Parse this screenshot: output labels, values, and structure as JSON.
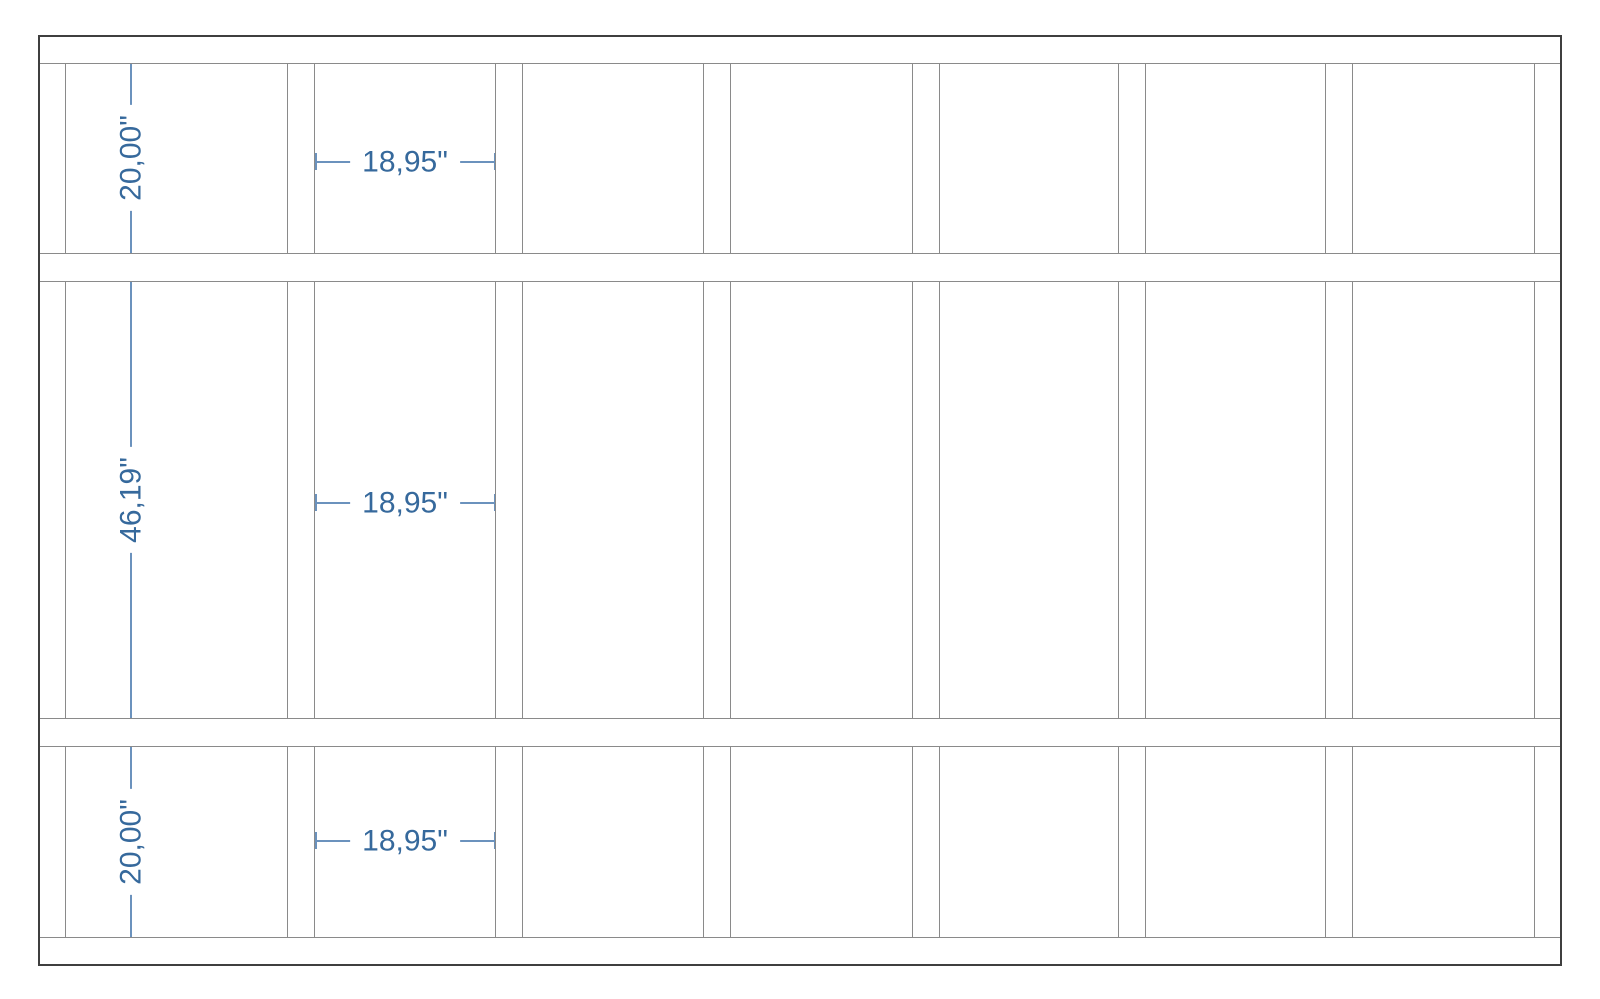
{
  "title": "Wall framing elevation drawing",
  "colors": {
    "background": "#ffffff",
    "frame_line": "#3f3f3f",
    "member_line": "#8a8a8a",
    "dim_line": "#6b92bd",
    "dim_ext_line": "#a9c1da",
    "dim_text": "#36699c"
  },
  "drawing": {
    "canvas": {
      "width": 1600,
      "height": 999
    },
    "frame": {
      "x": 38,
      "y": 35,
      "width": 1524,
      "height": 931
    },
    "horizontal_member_lines_y": [
      63,
      253,
      281,
      718,
      746,
      937
    ],
    "stud_bands": [
      {
        "name": "top-band",
        "y1": 63,
        "y2": 253
      },
      {
        "name": "middle-band",
        "y1": 281,
        "y2": 718
      },
      {
        "name": "bottom-band",
        "y1": 746,
        "y2": 937
      }
    ],
    "studs_x": [
      [
        38,
        66
      ],
      [
        287,
        315
      ],
      [
        495,
        523
      ],
      [
        703,
        731
      ],
      [
        912,
        940
      ],
      [
        1118,
        1146
      ],
      [
        1325,
        1353
      ],
      [
        1534,
        1562
      ]
    ]
  },
  "dimensions": {
    "vertical": [
      {
        "label": "20,00\"",
        "line_x": 130,
        "y1": 63,
        "y2": 253,
        "ext_x1": 50,
        "ext_x2": 154
      },
      {
        "label": "46,19\"",
        "line_x": 130,
        "y1": 281,
        "y2": 718,
        "ext_x1": 50,
        "ext_x2": 154
      },
      {
        "label": "20,00\"",
        "line_x": 130,
        "y1": 746,
        "y2": 937,
        "ext_x1": 50,
        "ext_x2": 154
      }
    ],
    "horizontal": [
      {
        "label": "18,95\"",
        "y": 161,
        "x1": 315,
        "x2": 495
      },
      {
        "label": "18,95\"",
        "y": 502,
        "x1": 315,
        "x2": 495
      },
      {
        "label": "18,95\"",
        "y": 840,
        "x1": 315,
        "x2": 495
      }
    ]
  }
}
